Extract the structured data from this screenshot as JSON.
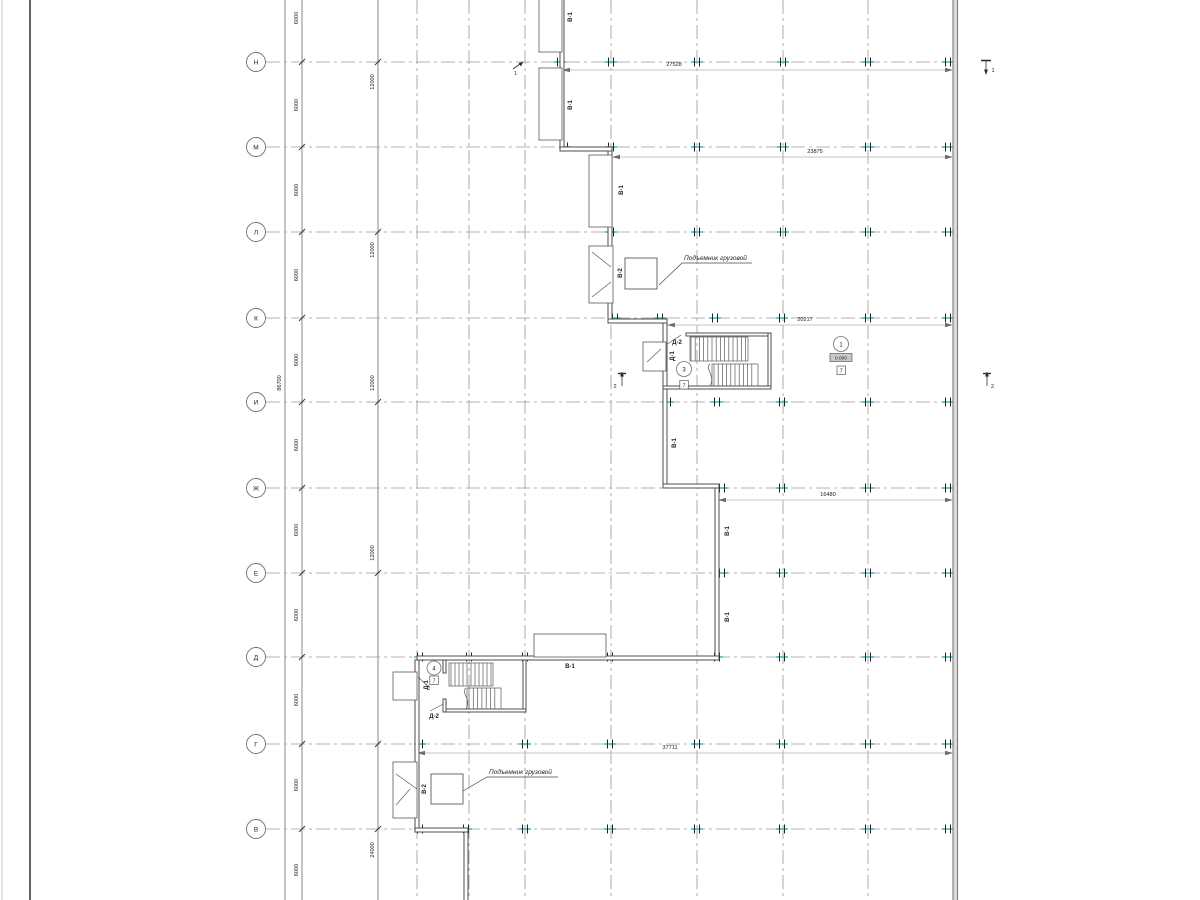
{
  "axes": {
    "rows": [
      "Н",
      "М",
      "Л",
      "К",
      "И",
      "Ж",
      "Е",
      "Д",
      "Г",
      "В"
    ]
  },
  "dims": {
    "overall": "86700",
    "bay": "6000",
    "double_bay": "12000",
    "quad_bay": "24000",
    "horizontal": [
      "27528",
      "23875",
      "20217",
      "16480",
      "37711"
    ]
  },
  "marks": {
    "gate1": "В-1",
    "gate2": "В-2",
    "door1": "Д-1",
    "door2": "Д-2"
  },
  "annotations": {
    "cargo_lift": "Подъемник грузовой"
  },
  "callouts": {
    "room1": {
      "number": "1",
      "elevation": "0.000",
      "finish": "7"
    },
    "room3": {
      "number": "3",
      "finish": "7"
    },
    "room4": {
      "number": "4",
      "finish": "7"
    }
  },
  "sections": {
    "one": "1",
    "two": "2"
  },
  "colors": {
    "tick_accent": "#3fbdbd",
    "wall": "#4d4d4d",
    "grid": "#9a9a9a",
    "dim_line": "#b3b3b3",
    "text": "#1c1c1c"
  }
}
